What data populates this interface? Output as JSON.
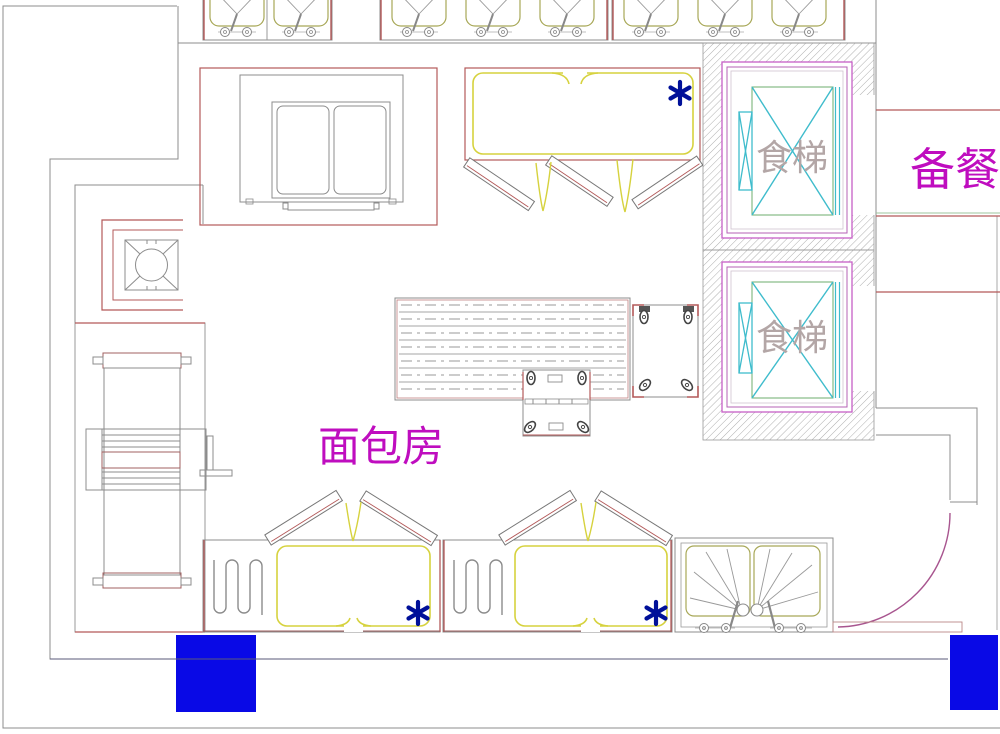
{
  "drawing": {
    "title": "bakery floor plan",
    "labels": {
      "bakery": "面包房",
      "prep_room": "备餐间",
      "dumbwaiter": "食梯"
    },
    "icons": {
      "asterisk": "equipment marker",
      "door_swing": "door arc",
      "hatch": "wall section hatch"
    },
    "equipment": [
      "top sink row left",
      "top sink row center",
      "top sink row right",
      "deck oven",
      "proofer cabinet",
      "dumbwaiter 1",
      "dumbwaiter 2",
      "gas burner",
      "dough sheeter",
      "work table",
      "trolley 1",
      "trolley 2",
      "oven unit 1",
      "oven unit 2",
      "double sink unit",
      "structural column 1",
      "structural column 2"
    ],
    "colors": {
      "wall_gray": "#8c8c8c",
      "line_red": "#b35959",
      "olive": "#a8a858",
      "yellow": "#d6d23e",
      "cyan": "#3fbccc",
      "green": "#6cae6c",
      "magenta_border": "#c75fc7",
      "magenta_text": "#bf0dbf",
      "elevator_text": "#b3a6a6",
      "column_blue": "#0909e6",
      "asterisk_blue": "#001099",
      "door_arc": "#a8558f"
    }
  }
}
